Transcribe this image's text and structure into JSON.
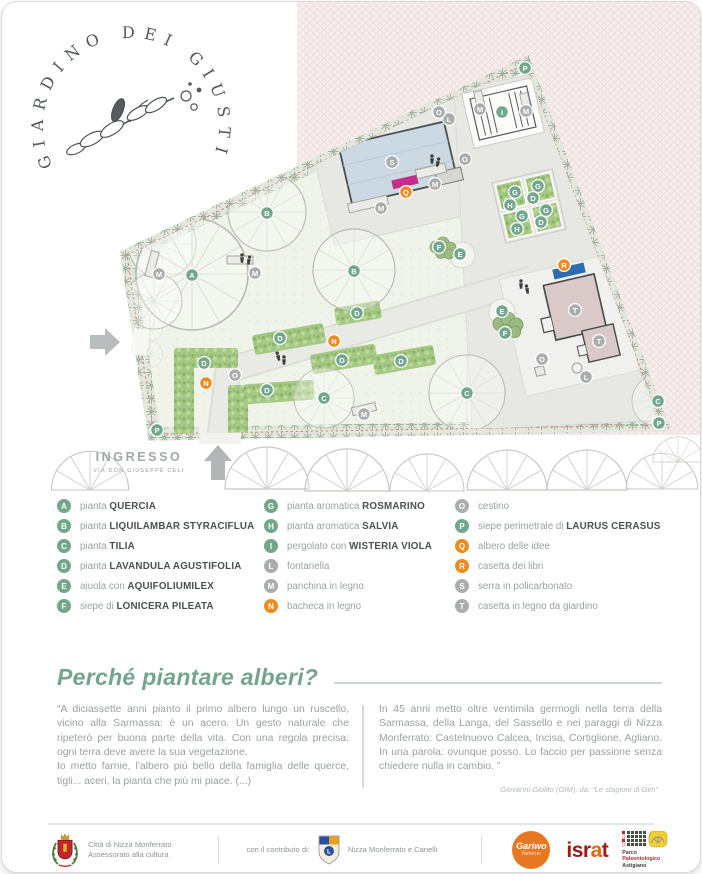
{
  "logo": {
    "arc_text": "GIARDINO DEI GIUSTI"
  },
  "map": {
    "entrance": {
      "label": "INGRESSO",
      "sublabel": "VIA DON GIUSEPPE CELI"
    },
    "marker_colors": {
      "green": "#72a78c",
      "gray": "#a9adae",
      "orange": "#f0891f"
    },
    "markers": [
      {
        "l": "P",
        "t": "green",
        "x": 523,
        "y": 66
      },
      {
        "l": "P",
        "t": "green",
        "x": 155,
        "y": 428
      },
      {
        "l": "P",
        "t": "green",
        "x": 657,
        "y": 421
      },
      {
        "l": "A",
        "t": "green",
        "x": 190,
        "y": 273
      },
      {
        "l": "B",
        "t": "green",
        "x": 265,
        "y": 211
      },
      {
        "l": "B",
        "t": "green",
        "x": 352,
        "y": 269
      },
      {
        "l": "C",
        "t": "green",
        "x": 322,
        "y": 396
      },
      {
        "l": "C",
        "t": "green",
        "x": 465,
        "y": 391
      },
      {
        "l": "C",
        "t": "green",
        "x": 656,
        "y": 399
      },
      {
        "l": "D",
        "t": "green",
        "x": 202,
        "y": 361
      },
      {
        "l": "D",
        "t": "green",
        "x": 265,
        "y": 388
      },
      {
        "l": "D",
        "t": "green",
        "x": 278,
        "y": 336
      },
      {
        "l": "D",
        "t": "green",
        "x": 340,
        "y": 358
      },
      {
        "l": "D",
        "t": "green",
        "x": 355,
        "y": 311
      },
      {
        "l": "D",
        "t": "green",
        "x": 399,
        "y": 359
      },
      {
        "l": "G",
        "t": "green",
        "x": 513,
        "y": 190
      },
      {
        "l": "H",
        "t": "green",
        "x": 508,
        "y": 203
      },
      {
        "l": "G",
        "t": "green",
        "x": 536,
        "y": 184
      },
      {
        "l": "D",
        "t": "green",
        "x": 531,
        "y": 196
      },
      {
        "l": "G",
        "t": "green",
        "x": 520,
        "y": 214
      },
      {
        "l": "H",
        "t": "green",
        "x": 515,
        "y": 227
      },
      {
        "l": "G",
        "t": "green",
        "x": 544,
        "y": 208
      },
      {
        "l": "D",
        "t": "green",
        "x": 539,
        "y": 220
      },
      {
        "l": "E",
        "t": "green",
        "x": 458,
        "y": 252
      },
      {
        "l": "F",
        "t": "green",
        "x": 437,
        "y": 245
      },
      {
        "l": "E",
        "t": "green",
        "x": 500,
        "y": 309
      },
      {
        "l": "F",
        "t": "green",
        "x": 503,
        "y": 331
      },
      {
        "l": "I",
        "t": "green",
        "x": 500,
        "y": 110
      },
      {
        "l": "L",
        "t": "gray",
        "x": 447,
        "y": 117
      },
      {
        "l": "L",
        "t": "gray",
        "x": 584,
        "y": 375
      },
      {
        "l": "M",
        "t": "gray",
        "x": 157,
        "y": 272
      },
      {
        "l": "M",
        "t": "gray",
        "x": 253,
        "y": 271
      },
      {
        "l": "M",
        "t": "gray",
        "x": 379,
        "y": 206
      },
      {
        "l": "M",
        "t": "gray",
        "x": 433,
        "y": 182
      },
      {
        "l": "M",
        "t": "gray",
        "x": 478,
        "y": 107
      },
      {
        "l": "M",
        "t": "gray",
        "x": 524,
        "y": 109
      },
      {
        "l": "M",
        "t": "gray",
        "x": 362,
        "y": 412
      },
      {
        "l": "N",
        "t": "orange",
        "x": 204,
        "y": 381
      },
      {
        "l": "N",
        "t": "orange",
        "x": 332,
        "y": 339
      },
      {
        "l": "O",
        "t": "gray",
        "x": 437,
        "y": 110
      },
      {
        "l": "O",
        "t": "gray",
        "x": 463,
        "y": 157
      },
      {
        "l": "O",
        "t": "gray",
        "x": 233,
        "y": 373
      },
      {
        "l": "O",
        "t": "gray",
        "x": 540,
        "y": 357
      },
      {
        "l": "Q",
        "t": "orange",
        "x": 404,
        "y": 190
      },
      {
        "l": "R",
        "t": "orange",
        "x": 562,
        "y": 263
      },
      {
        "l": "S",
        "t": "gray",
        "x": 390,
        "y": 160
      },
      {
        "l": "T",
        "t": "gray",
        "x": 573,
        "y": 308
      },
      {
        "l": "T",
        "t": "gray",
        "x": 597,
        "y": 339
      }
    ]
  },
  "legend": {
    "columns": [
      [
        {
          "l": "A",
          "c": "green",
          "p": "pianta",
          "n": "QUERCIA"
        },
        {
          "l": "B",
          "c": "green",
          "p": "pianta",
          "n": "LIQUILAMBAR STYRACIFLUA"
        },
        {
          "l": "C",
          "c": "green",
          "p": "pianta",
          "n": "TILIA"
        },
        {
          "l": "D",
          "c": "green",
          "p": "pianta",
          "n": "LAVANDULA AGUSTIFOLIA"
        },
        {
          "l": "E",
          "c": "green",
          "p": "aiuola con",
          "n": "AQUIFOLIUMILEX"
        },
        {
          "l": "F",
          "c": "green",
          "p": "siepe di",
          "n": "LONICERA PILEATA"
        }
      ],
      [
        {
          "l": "G",
          "c": "green",
          "p": "pianta aromatica",
          "n": "ROSMARINO"
        },
        {
          "l": "H",
          "c": "green",
          "p": "pianta aromatica",
          "n": "SALVIA"
        },
        {
          "l": "I",
          "c": "green",
          "p": "pergolato con",
          "n": "WISTERIA VIOLA"
        },
        {
          "l": "L",
          "c": "gray",
          "p": "fontanella",
          "n": ""
        },
        {
          "l": "M",
          "c": "gray",
          "p": "panchina in legno",
          "n": ""
        },
        {
          "l": "N",
          "c": "orange",
          "p": "bacheca in legno",
          "n": ""
        }
      ],
      [
        {
          "l": "O",
          "c": "gray",
          "p": "cestino",
          "n": ""
        },
        {
          "l": "P",
          "c": "green",
          "p": "siepe perimetrale di",
          "n": "LAURUS CERASUS"
        },
        {
          "l": "Q",
          "c": "orange",
          "p": "albero delle idee",
          "n": ""
        },
        {
          "l": "R",
          "c": "orange",
          "p": "casetta dei libri",
          "n": ""
        },
        {
          "l": "S",
          "c": "gray",
          "p": "serra in policarbonato",
          "n": ""
        },
        {
          "l": "T",
          "c": "gray",
          "p": "casetta in legno da giardino",
          "n": ""
        }
      ]
    ]
  },
  "quote": {
    "title": "Perché piantare alberi?",
    "left1": "“A diciassette anni pianto il primo albero lungo un ruscello, vicino alla Sarmassa: è un acero. Un gesto naturale che ripeterò per buona parte della vita. Con una regola precisa: ogni terra deve avere la sua vegetazione.",
    "left2": "Io metto farnie, l'albero più bello della famiglia delle querce, tigli... aceri, la pianta che più mi piace. (...)",
    "right": "In 45 anni metto oltre ventimila germogli nella terra della Sarmassa, della Langa, del Sassello e nei paraggi di Nizza Monferrato: Castelnuovo Calcea, Incisa, Cortiglione, Agliano. In una parola: ovunque posso. Lo faccio per passione senza chiedere nulla in cambio. ”",
    "attribution": "Giovanni Giolito (GIM), da: “Le stagioni di Gim”"
  },
  "footer": {
    "city_line1": "Città di Nizza Monferrato",
    "city_line2": "Assessorato alla cultura",
    "contribution": "con il contributo di:",
    "lions_text": "Nizza Monferrato e Canelli",
    "lions_letter": "L",
    "gariwo_line1": "Gariwo",
    "gariwo_line2": "Network",
    "israt_part1": "isr",
    "israt_part2": "a",
    "israt_part3": "t",
    "parco_line1": "Parco",
    "parco_line2": "Paleontologico",
    "parco_line3": "Astigiano"
  }
}
